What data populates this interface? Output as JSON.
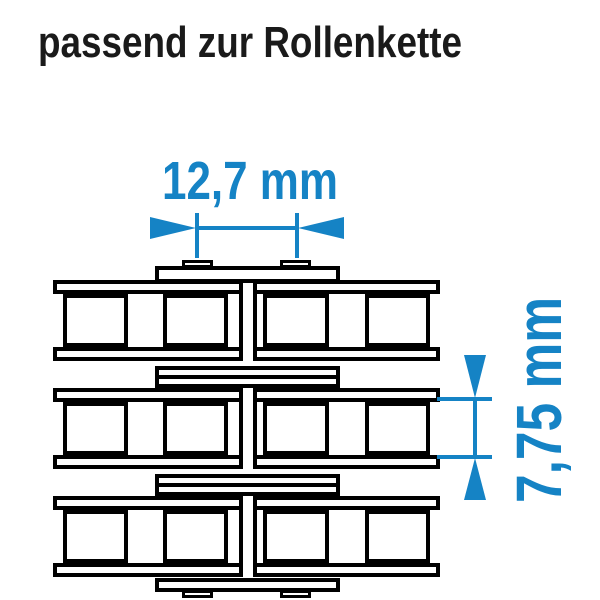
{
  "title": "passend zur Rollenkette",
  "dimensions": {
    "pitch_label": "12,7 mm",
    "roller_label": "7,75 mm"
  },
  "diagram": {
    "subject": "duplex-roller-chain-top-view",
    "rows": 3,
    "rollers_per_row": 4
  },
  "colors": {
    "accent": "#1583c5",
    "line": "#000000",
    "title": "#1a1a1a",
    "background": "#ffffff"
  }
}
